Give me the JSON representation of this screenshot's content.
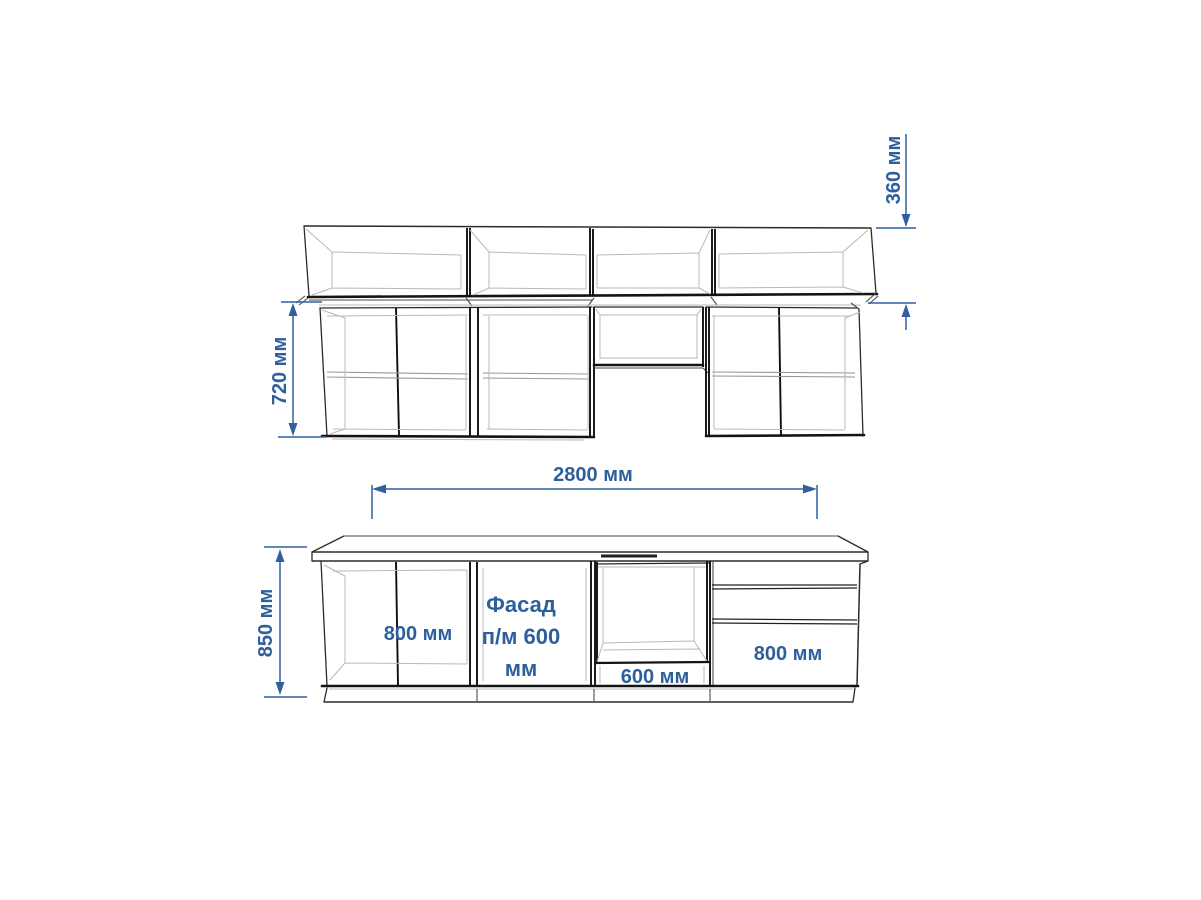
{
  "drawing": {
    "kind": "kitchen-furniture-elevation",
    "background_color": "#ffffff",
    "outline_color": "#2b2b2b",
    "accent_color": "#2e5f9d"
  },
  "wall_section": {
    "upper_tier_height_dim": "360 мм",
    "lower_tier_height_dim": "720 мм"
  },
  "base_section": {
    "total_length_dim": "2800 мм",
    "height_dim": "850 мм",
    "left_cabinet_label": "800 мм",
    "facade": {
      "line1": "Фасад",
      "line2": "п/м 600",
      "line3": "мм"
    },
    "oven_cabinet_label": "600 мм",
    "drawer_cabinet_label": "800 мм"
  }
}
